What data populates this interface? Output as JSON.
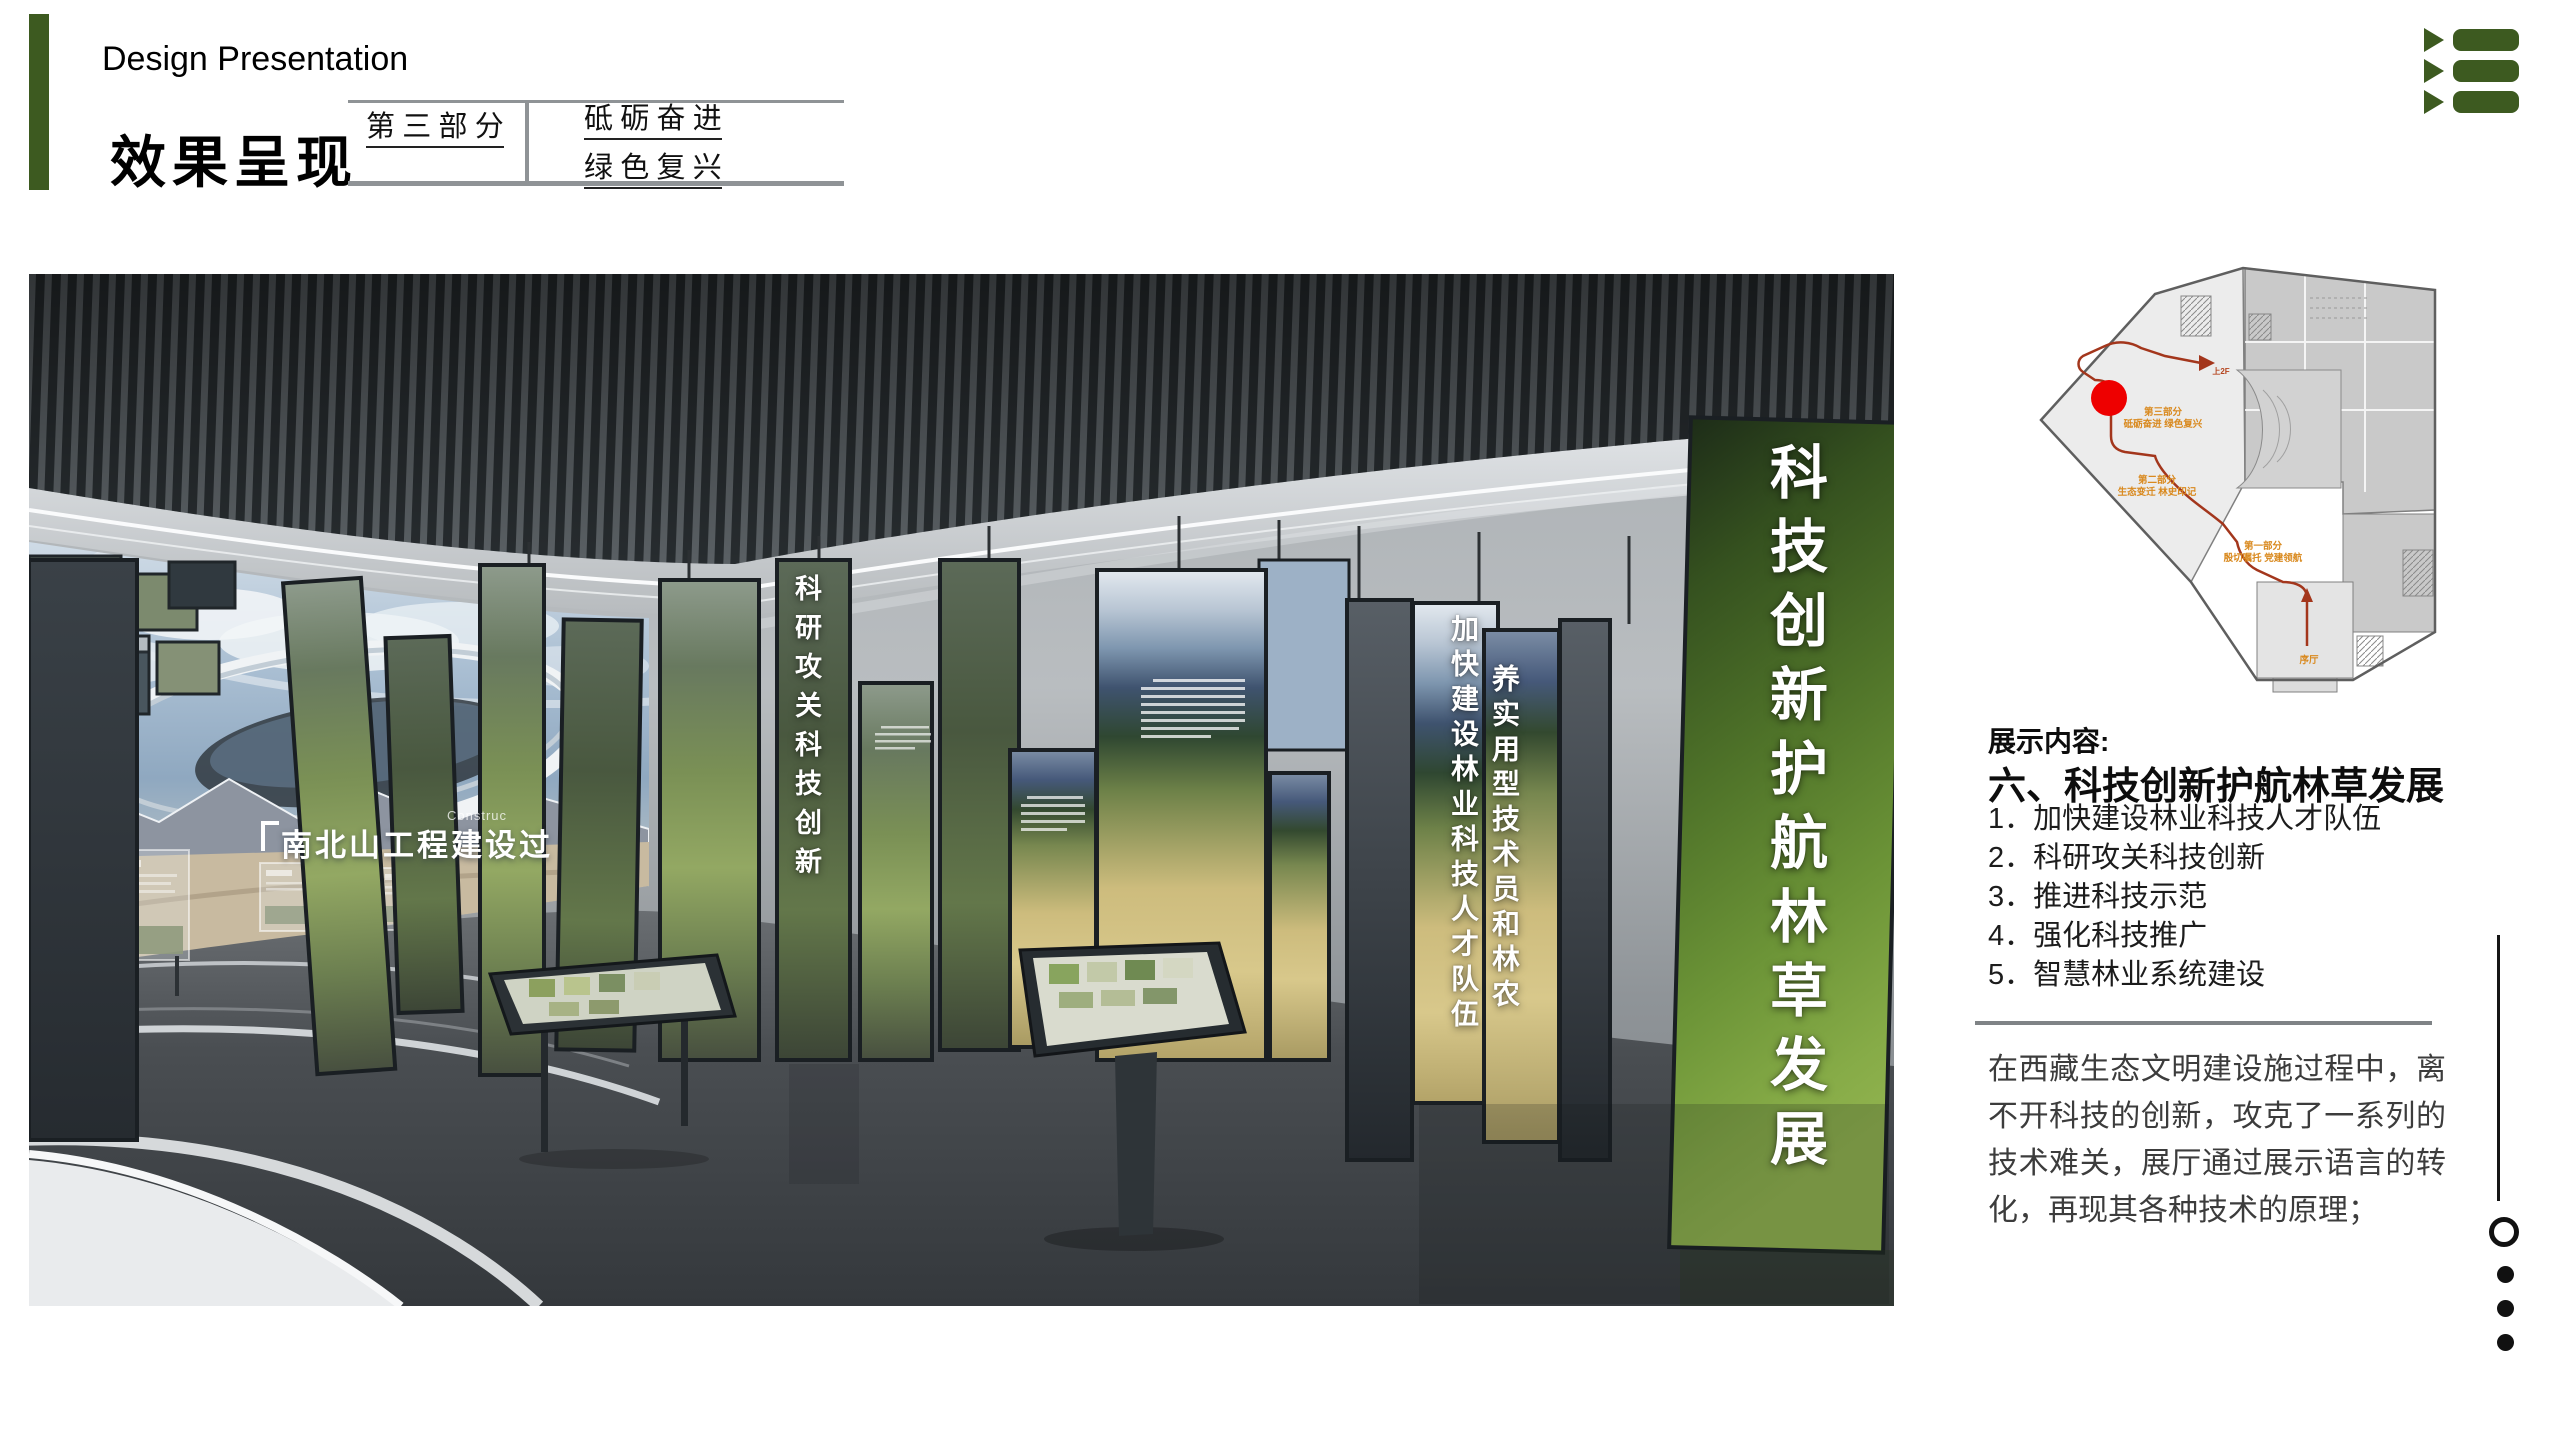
{
  "slide": {
    "subtitle": "Design Presentation",
    "title": "效果呈现",
    "part": {
      "label": "第 三 部 分",
      "line1": "砥 砺 奋 进",
      "line2": "绿 色 复 兴"
    }
  },
  "render": {
    "screen_title": "南北山工程建设过",
    "screen_title_en": "Construc",
    "panel_keyan": "科研攻关科技创新",
    "panel_jiakuai": "加快建设林业科技人才队伍",
    "panel_yang": "养实用型技术员和林农",
    "panel_big": "科技创新护航林草发展"
  },
  "floorplan": {
    "part3_title": "第三部分",
    "part3_sub": "砥砺奋进 绿色复兴",
    "part2_title": "第二部分",
    "part2_sub": "生态变迁 林史印记",
    "part1_title": "第一部分",
    "part1_sub": "殷切嘱托 党建领航",
    "lobby": "序厅",
    "to_2f": "上2F"
  },
  "content": {
    "heading": "展示内容:",
    "section_title": "六、科技创新护航林草发展",
    "items": [
      "1．加快建设林业科技人才队伍",
      "2．科研攻关科技创新",
      "3．推进科技示范",
      "4．强化科技推广",
      "5．智慧林业系统建设"
    ],
    "paragraph": "在西藏生态文明建设施过程中，离不开科技的创新，攻克了一系列的技术难关，展厅通过展示语言的转化，再现其各种技术的原理；"
  },
  "colors": {
    "accent_green": "#3d5a20",
    "route_red": "#a3361c",
    "marker_red": "#ee0000",
    "label_orange": "#d9891e"
  }
}
